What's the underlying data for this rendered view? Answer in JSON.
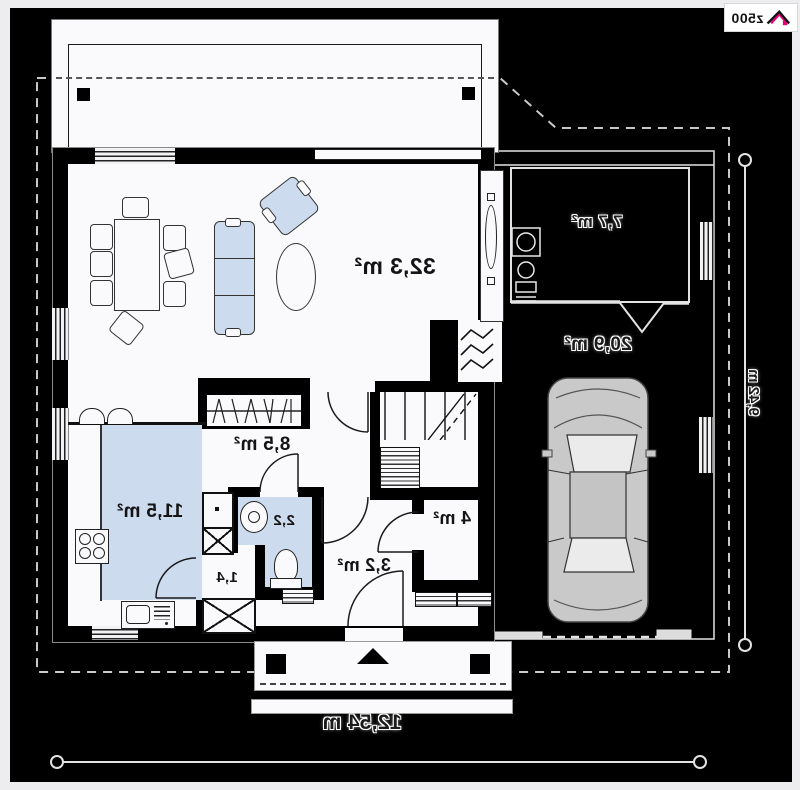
{
  "brand": {
    "logo_text": "z500"
  },
  "plan": {
    "rooms": {
      "living": {
        "label": "32,3 m²"
      },
      "storage": {
        "label": "7,7 m²"
      },
      "garage": {
        "label": "20,9 m²"
      },
      "hall": {
        "label": "8,5 m²"
      },
      "kitchen": {
        "label": "11,5 m²"
      },
      "wc": {
        "label": "2,2"
      },
      "pantry": {
        "label": "1,4"
      },
      "vestibule": {
        "label": "3,2 m²"
      },
      "bathroom": {
        "label": "4 m²"
      }
    },
    "dimensions": {
      "overall_width": "12,54 m",
      "overall_depth": "9,42 m"
    }
  },
  "colors": {
    "background": "#000000",
    "floor": "#fafafc",
    "furniture_fill": "#ccdbee",
    "brand_pink": "#e5007d",
    "boundary_dash": "#c9c9cd"
  }
}
